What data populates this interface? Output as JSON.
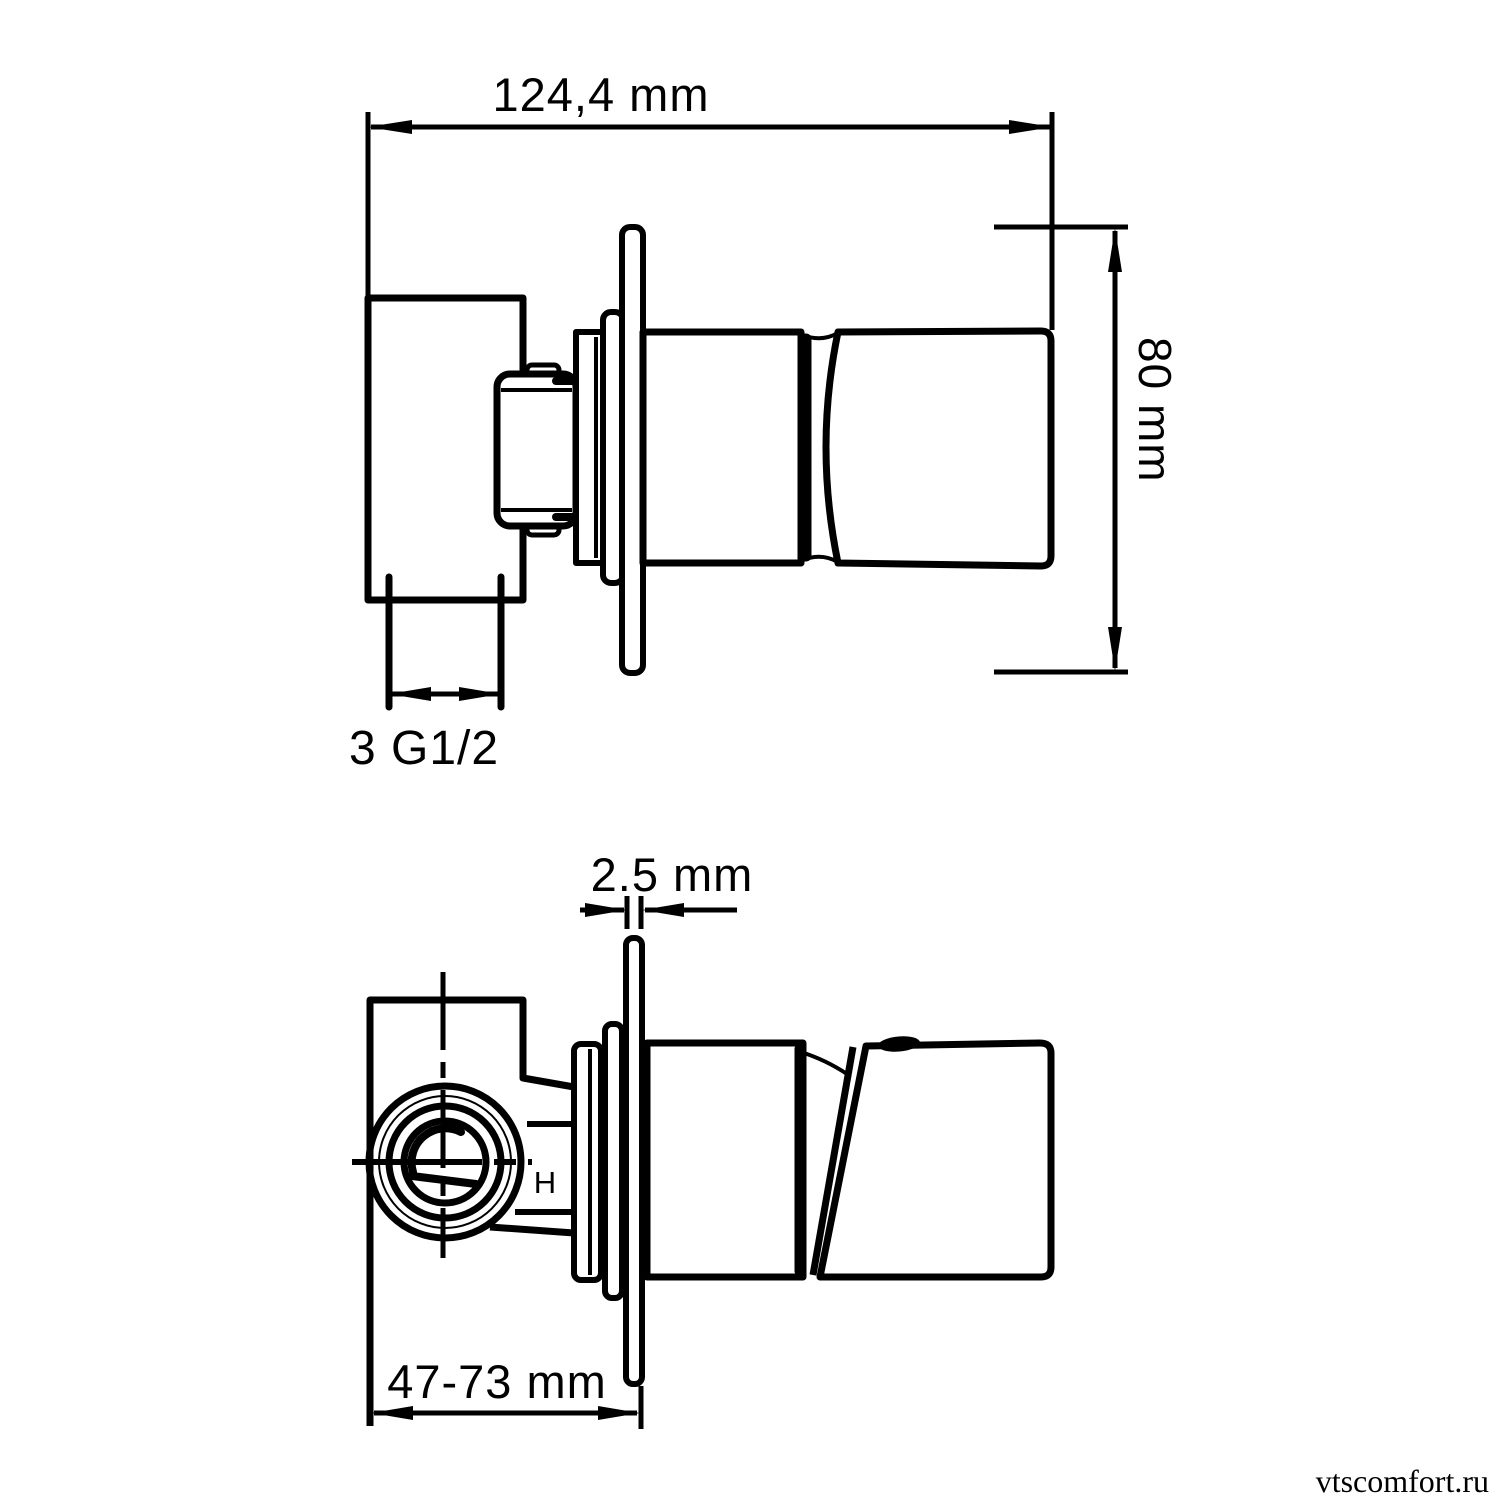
{
  "drawing": {
    "stroke_color": "#000000",
    "background": "#ffffff",
    "views": [
      {
        "id": "side-view",
        "dimensions": [
          {
            "name": "overall-width",
            "label": "124,4 mm"
          },
          {
            "name": "plate-height",
            "label": "80 mm"
          },
          {
            "name": "thread-connection",
            "label": "3 G1/2"
          }
        ]
      },
      {
        "id": "top-view",
        "dimensions": [
          {
            "name": "plate-thickness",
            "label": "2.5 mm"
          },
          {
            "name": "installation-depth",
            "label": "47-73 mm"
          }
        ],
        "marker": "H"
      }
    ]
  },
  "watermark": {
    "text": "vtscomfort.ru",
    "color": "#9aa0a4"
  }
}
